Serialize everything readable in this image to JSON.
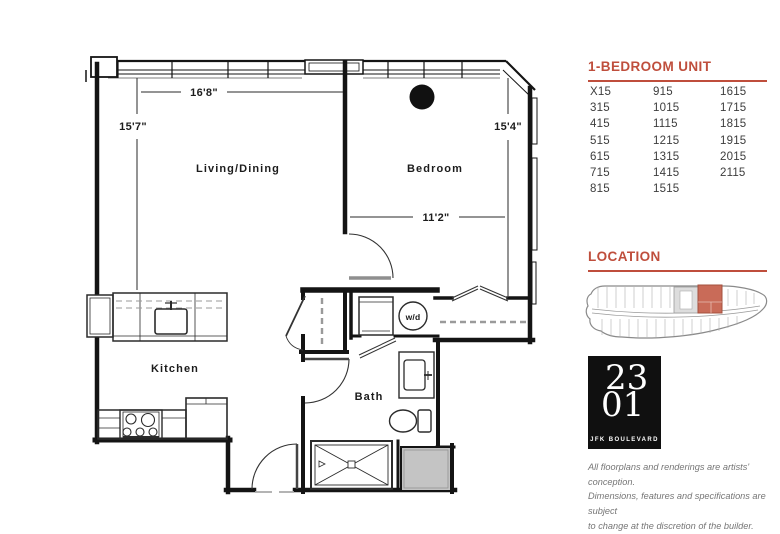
{
  "colors": {
    "accent_red": "#bf4e3c",
    "highlight_unit_fill": "#c96b58",
    "wall_black": "#141414",
    "shaft_gray": "#c4c4c4",
    "unit_number_text": "#3d3d3d",
    "disclaimer_gray": "#767676"
  },
  "floorplan": {
    "labels": {
      "living": "Living/Dining",
      "bedroom": "Bedroom",
      "kitchen": "Kitchen",
      "bath": "Bath",
      "washer_dryer": "w/d"
    },
    "dimensions": {
      "living_width": "16'8\"",
      "living_depth": "15'7\"",
      "bedroom_depth": "15'4\"",
      "bedroom_width": "11'2\""
    }
  },
  "sidebar": {
    "unit_list": {
      "title": "1-BEDROOM UNIT",
      "rows": [
        [
          "X15",
          "915",
          "1615"
        ],
        [
          "315",
          "1015",
          "1715"
        ],
        [
          "415",
          "1115",
          "1815"
        ],
        [
          "515",
          "1215",
          "1915"
        ],
        [
          "615",
          "1315",
          "2015"
        ],
        [
          "715",
          "1415",
          "2115"
        ],
        [
          "815",
          "1515",
          ""
        ]
      ]
    },
    "location": {
      "title": "LOCATION"
    },
    "logo": {
      "top": "23",
      "bottom": "01",
      "subtitle": "JFK BOULEVARD"
    },
    "disclaimer": {
      "line1": "All floorplans and renderings are artists' conception.",
      "line2": "Dimensions, features and specifications are subject",
      "line3": "to change at the discretion of the builder."
    }
  }
}
